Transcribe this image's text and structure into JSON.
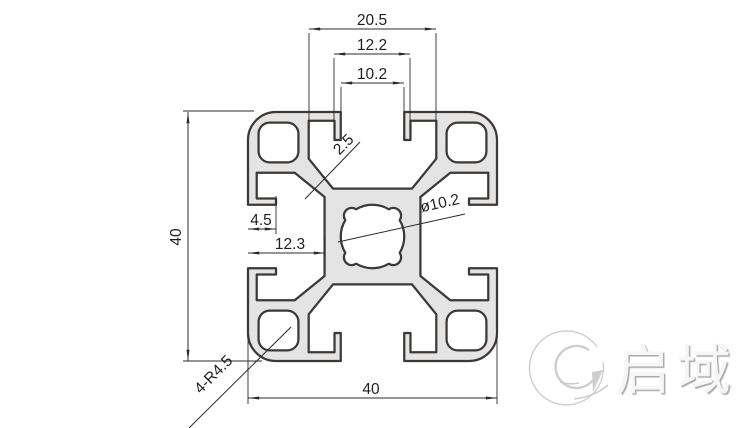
{
  "drawing": {
    "type": "technical-cross-section",
    "subject": "40x40 T-slot aluminium extrusion profile",
    "dimensions": {
      "slot_cavity_width": "20.5",
      "slot_step_width": "12.2",
      "slot_opening_width": "10.2",
      "overall_height": "40",
      "overall_width": "40",
      "lip_depth": "4.5",
      "slot_depth": "12.3",
      "web_thickness": "2.5",
      "center_bore": "ø10.2",
      "corner_radius_note": "4-R4.5"
    },
    "watermark": {
      "logo_icon": "q-swirl-circle",
      "brand_text": "启域"
    },
    "colors": {
      "profile_fill": "#e4e4e4",
      "profile_stroke": "#3c3836",
      "dim_line": "#2b2b2b",
      "watermark_gray": "#c6c6c6",
      "background": "#ffffff"
    }
  }
}
